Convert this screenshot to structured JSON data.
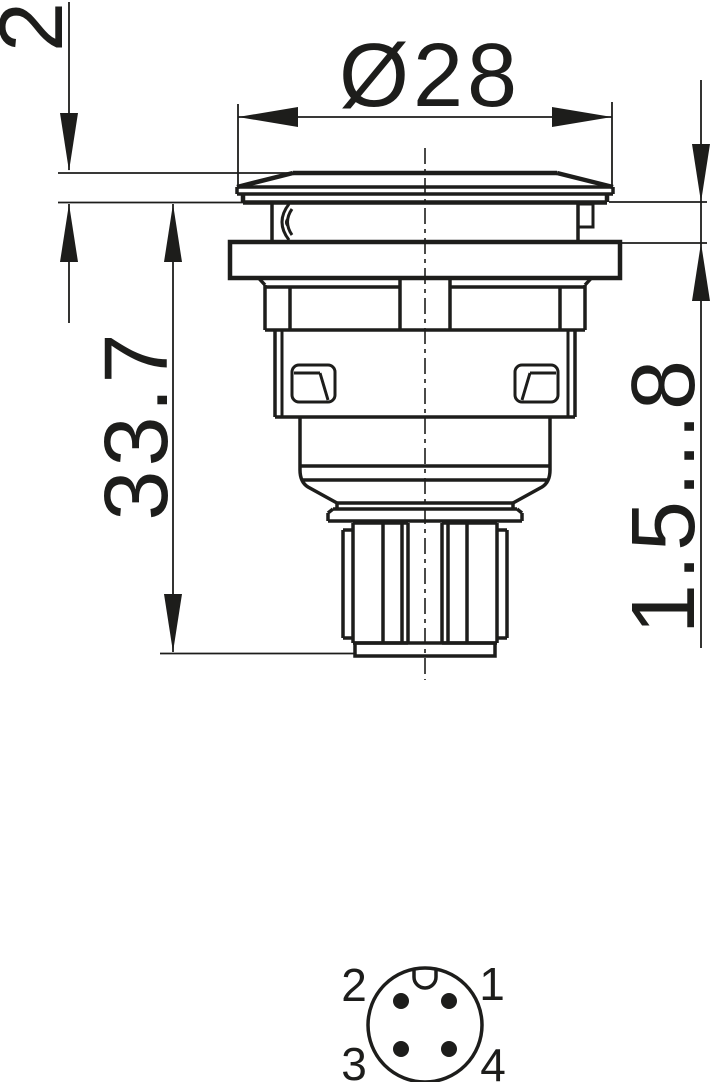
{
  "drawing": {
    "background": "#ffffff",
    "line_color": "#1d1d1b",
    "view_side": {
      "dimensions": {
        "cap_protrusion": "2",
        "cap_diameter": "Ø28",
        "overall_depth": "33.7",
        "panel_thickness_range": "1.5...8"
      }
    },
    "view_pinout": {
      "pins": [
        {
          "number": "2",
          "position": "top-left"
        },
        {
          "number": "1",
          "position": "top-right"
        },
        {
          "number": "3",
          "position": "bottom-left"
        },
        {
          "number": "4",
          "position": "bottom-right"
        }
      ]
    }
  }
}
